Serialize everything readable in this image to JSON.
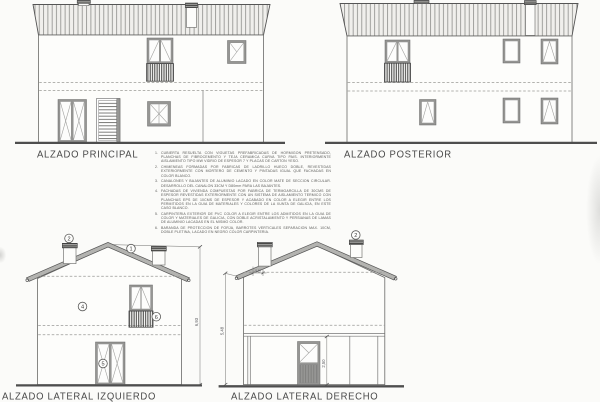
{
  "sheet": {
    "background": "#fbfbf9",
    "line_color": "#4e4e4e",
    "frame_gray": "#969694",
    "roof_gray": "#b3b3b0"
  },
  "elevations": {
    "principal": {
      "title": "ALZADO PRINCIPAL"
    },
    "posterior": {
      "title": "ALZADO POSTERIOR"
    },
    "lateral_izquierdo": {
      "title": "ALZADO LATERAL IZQUIERDO"
    },
    "lateral_derecho": {
      "title": "ALZADO LATERAL DERECHO"
    }
  },
  "callouts": {
    "roof": "1",
    "chimney": "2",
    "facade": "4",
    "door": "5",
    "railing": "6",
    "chimney_derecho": "2"
  },
  "dimensions": {
    "izquierdo_total_height": "6,93",
    "derecho_eave_height": "5,48",
    "derecho_ground_floor": "2,50",
    "derecho_chimney": "0,40"
  },
  "notes": {
    "items": [
      {
        "num": "1.",
        "text": "CUBIERTA RESUELTA CON VIGUETAS PREFABRICADAS DE HORMIGON PRETENSADO, PLANCHAS DE FIBROCEMENTO Y TEJA CERAMICA CURVA TIPO PAIS. INTERIORMENTE AISLAMIENTO TIPO MW VIDRIO DE ESPESOR 7 Y PLACAS DE CARTON YESO."
      },
      {
        "num": "2.",
        "text": "CHIMENEAS FORMADAS POR FABRICAS DE LADRILLO HUECO DOBLE, REVESTIDAS EXTERIORMENTE CON MORTERO DE CEMENTO Y PINTADAS IGUAL QUE FACHADAS EN COLOR BLANCO."
      },
      {
        "num": "3.",
        "text": "CANALONES Y BAJANTES DE ALUMINIO LACADO EN COLOR MATE DE SECCION CIRCULAR. DESARROLLO DEL CANALON 33CM Y D80mm PARA LAS BAJANTES."
      },
      {
        "num": "4.",
        "text": "FACHADAS DE VIVIENDA COMPUESTAS POR FABRICA DE TERMOARCILLA DE 30CMS DE ESPESOR REVESTIDAS EXTERIORMENTE CON UN SISTEMA DE AISLAMIENTO TERMICO CON PLANCHAS EPS DE 10CMS DE ESPESOR Y ACABADO EN COLOR A ELEGIR ENTRE LOS PERMITIDOS EN LA GUIA DE MATERIALES Y COLORES DE LA XUNTA DE GALICIA, EN ESTE CASO BLANCO."
      },
      {
        "num": "5.",
        "text": "CARPINTERIA EXTERIOR DE PVC COLOR A ELEGIR ENTRE LOS ADMITIDOS EN LA GUIA DE COLOR Y MATERIALES DE GALICIA, CON DOBLE ACRISTALAMIENTO Y PERSIANAS DE LAMAS DE ALUMINIO LACADAS EN EL MISMO COLOR."
      },
      {
        "num": "6.",
        "text": "BARANDA DE PROTECCION DE FORJA, BARROTES VERTICALES SEPARACION MAX. 10CM, DOBLE PLETINA, LACADO EN NEGRO COLOR CARPINTERIA."
      }
    ]
  }
}
